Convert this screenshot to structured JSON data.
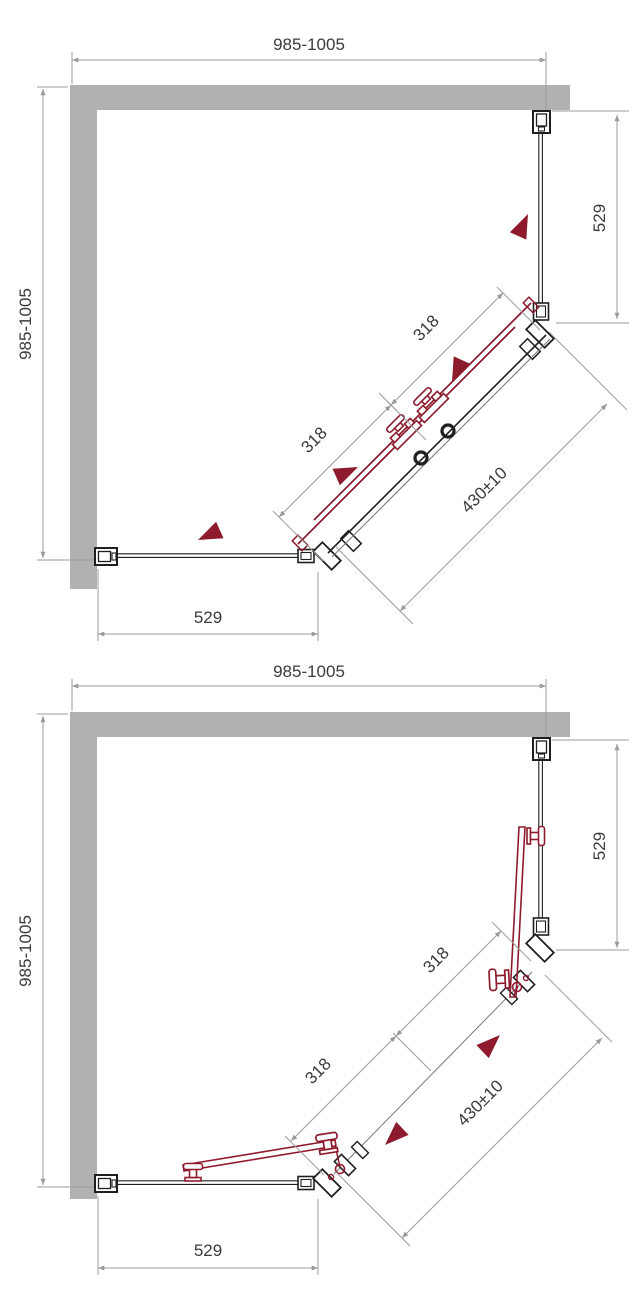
{
  "colors": {
    "wall_gray": "#b1b1b1",
    "dimension_gray": "#9b9b9b",
    "drawing_ink": "#1f1f1f",
    "accent_red": "#8d1b2d"
  },
  "diagrams": [
    {
      "name": "plan-view-sliding-doors-closed",
      "labels": {
        "overall_width": "985-1005",
        "overall_depth": "985-1005",
        "right_panel_width": "529",
        "bottom_panel_width": "529",
        "upper_door_width": "318",
        "lower_door_width": "318",
        "door_leaf_width": "430±10"
      }
    },
    {
      "name": "plan-view-doors-open",
      "labels": {
        "overall_width": "985-1005",
        "overall_depth": "985-1005",
        "right_panel_width": "529",
        "bottom_panel_width": "529",
        "upper_door_width": "318",
        "lower_door_width": "318",
        "door_leaf_width": "430±10"
      }
    }
  ]
}
